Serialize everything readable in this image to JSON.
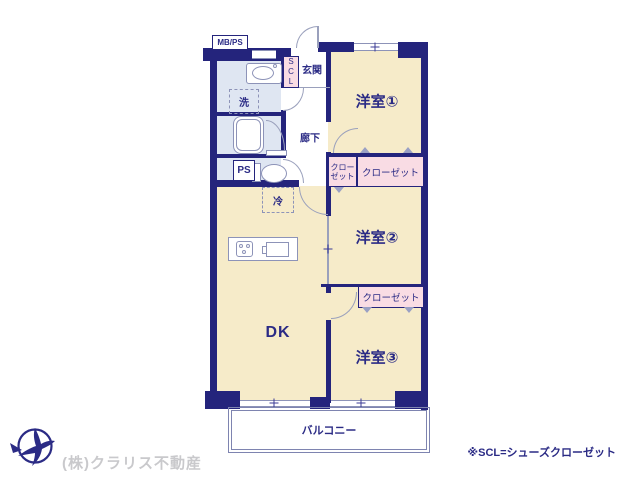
{
  "colors": {
    "wall_navy": "#24247c",
    "room_cream": "#f6ebc9",
    "wet_blue": "#dfe6f2",
    "closet_pink": "#f9dce4",
    "label_navy": "#2b2b85",
    "footer_gray": "#c9c9cc"
  },
  "rooms": {
    "room1": "洋室①",
    "room2": "洋室②",
    "room3": "洋室③",
    "dk": "DK",
    "genkan": "玄関",
    "corridor": "廊下",
    "balcony": "バルコニー"
  },
  "features": {
    "mbps": "MB/PS",
    "ps": "PS",
    "scl": "SCL",
    "washer": "洗",
    "fridge": "冷",
    "closet": "クローゼット",
    "closet_line1": "クロー",
    "closet_line2": "ゼット"
  },
  "footer": {
    "company": "(株)クラリス不動産",
    "note": "※SCL=シューズクローゼット"
  }
}
